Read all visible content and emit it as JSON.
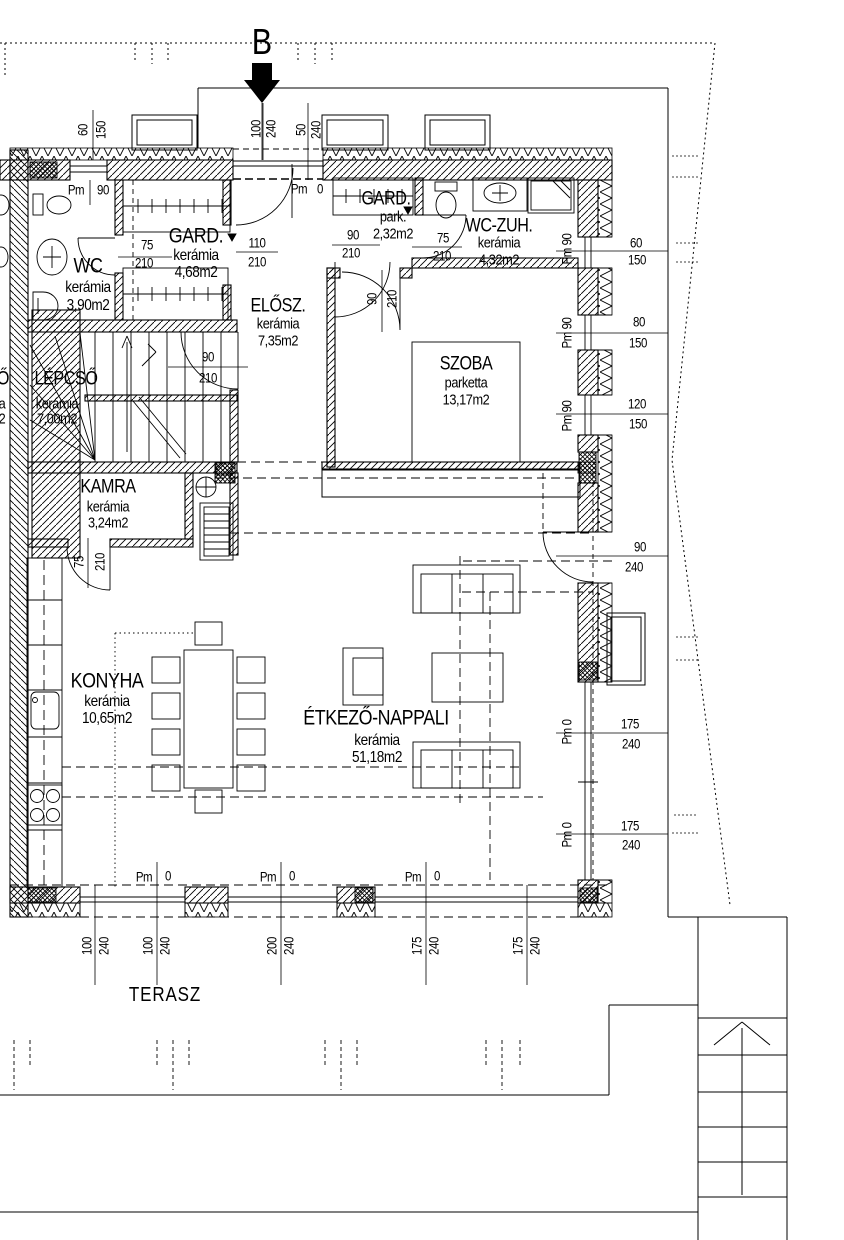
{
  "drawing": {
    "section_marker": "B",
    "terrace_label": "TERASZ",
    "colors": {
      "line": "#000000",
      "background": "#ffffff"
    },
    "rooms": [
      {
        "name": "WC",
        "floor": "kerámia",
        "area": "3,90m2",
        "x": 88,
        "ny": 266,
        "fy": 288,
        "ay": 306,
        "ns": 21,
        "ss": 16
      },
      {
        "name": "GARD.",
        "floor": "kerámia",
        "area": "4,68m2",
        "x": 196,
        "ny": 236,
        "fy": 256,
        "ay": 273,
        "ns": 21,
        "ss": 16
      },
      {
        "name": "ELŐSZ.",
        "floor": "kerámia",
        "area": "7,35m2",
        "x": 278,
        "ny": 306,
        "fy": 324,
        "ay": 341,
        "ns": 19,
        "ss": 15
      },
      {
        "name": "GARD.",
        "floor": "park.",
        "area": "2,32m2",
        "x": 386,
        "ny": 199,
        "fy": 217,
        "sx": 393,
        "ay": 234,
        "ns": 19,
        "ss": 15
      },
      {
        "name": "WC-ZUH.",
        "floor": "kerámia",
        "area": "4,32m2",
        "x": 499,
        "ny": 226,
        "fy": 243,
        "ay": 260,
        "ns": 19,
        "ss": 15
      },
      {
        "name": "SZOBA",
        "floor": "parketta",
        "area": "13,17m2",
        "x": 466,
        "ny": 364,
        "fy": 383,
        "ay": 400,
        "ns": 19,
        "ss": 15
      },
      {
        "name": "LÉPCSŐ",
        "floor": "kerámia",
        "area": "7,00m2",
        "x": 66,
        "ny": 379,
        "sx": 57,
        "fy": 404,
        "ay": 419,
        "ns": 19,
        "ss": 15
      },
      {
        "name": "KAMRA",
        "floor": "kerámia",
        "area": "3,24m2",
        "x": 108,
        "ny": 487,
        "fy": 507,
        "ay": 523,
        "ns": 19,
        "ss": 15
      },
      {
        "name": "KONYHA",
        "floor": "kerámia",
        "area": "10,65m2",
        "x": 107,
        "ny": 681,
        "fy": 702,
        "ay": 719,
        "ns": 21,
        "ss": 16
      },
      {
        "name": "ÉTKEZŐ-NAPPALI",
        "floor": "kerámia",
        "area": "51,18m2",
        "x": 376,
        "ny": 718,
        "sx": 377,
        "fy": 741,
        "ay": 758,
        "ns": 21,
        "ss": 16
      }
    ],
    "partial_labels": [
      {
        "t": "Ő",
        "x": 3,
        "y": 379,
        "s": 19
      },
      {
        "t": "a",
        "x": 2,
        "y": 404,
        "s": 15
      },
      {
        "t": "2",
        "x": 2,
        "y": 419,
        "s": 15
      }
    ],
    "dim_labels": [
      {
        "t": "60",
        "x": 83,
        "y": 130,
        "r": -90
      },
      {
        "t": "150",
        "x": 101,
        "y": 130,
        "r": -90
      },
      {
        "t": "100",
        "x": 256,
        "y": 129,
        "r": -90
      },
      {
        "t": "240",
        "x": 271,
        "y": 129,
        "r": -90
      },
      {
        "t": "50",
        "x": 301,
        "y": 130,
        "r": -90
      },
      {
        "t": "240",
        "x": 316,
        "y": 130,
        "r": -90
      },
      {
        "t": "Pm",
        "x": 76,
        "y": 190
      },
      {
        "t": "90",
        "x": 103,
        "y": 190
      },
      {
        "t": "Pm",
        "x": 299,
        "y": 189
      },
      {
        "t": "0",
        "x": 320,
        "y": 189
      },
      {
        "t": "75",
        "x": 147,
        "y": 245
      },
      {
        "t": "210",
        "x": 144,
        "y": 263
      },
      {
        "t": "110",
        "x": 257,
        "y": 243
      },
      {
        "t": "210",
        "x": 257,
        "y": 262
      },
      {
        "t": "90",
        "x": 353,
        "y": 235
      },
      {
        "t": "210",
        "x": 351,
        "y": 253
      },
      {
        "t": "75",
        "x": 443,
        "y": 238
      },
      {
        "t": "210",
        "x": 442,
        "y": 256
      },
      {
        "t": "90",
        "x": 208,
        "y": 357
      },
      {
        "t": "210",
        "x": 208,
        "y": 378
      },
      {
        "t": "90",
        "x": 372,
        "y": 299,
        "r": -90
      },
      {
        "t": "210",
        "x": 392,
        "y": 299,
        "r": -90
      },
      {
        "t": "75",
        "x": 79,
        "y": 562,
        "r": -90
      },
      {
        "t": "210",
        "x": 100,
        "y": 562,
        "r": -90
      },
      {
        "t": "Pm 90",
        "x": 567,
        "y": 249,
        "r": -90
      },
      {
        "t": "Pm 90",
        "x": 567,
        "y": 333,
        "r": -90
      },
      {
        "t": "Pm 90",
        "x": 567,
        "y": 416,
        "r": -90
      },
      {
        "t": "Pm 0",
        "x": 567,
        "y": 732,
        "r": -90
      },
      {
        "t": "Pm 0",
        "x": 567,
        "y": 835,
        "r": -90
      },
      {
        "t": "60",
        "x": 636,
        "y": 243
      },
      {
        "t": "150",
        "x": 637,
        "y": 260
      },
      {
        "t": "80",
        "x": 639,
        "y": 322
      },
      {
        "t": "150",
        "x": 638,
        "y": 343
      },
      {
        "t": "120",
        "x": 637,
        "y": 404
      },
      {
        "t": "150",
        "x": 638,
        "y": 424
      },
      {
        "t": "90",
        "x": 640,
        "y": 547
      },
      {
        "t": "240",
        "x": 634,
        "y": 567
      },
      {
        "t": "175",
        "x": 630,
        "y": 724
      },
      {
        "t": "240",
        "x": 631,
        "y": 744
      },
      {
        "t": "175",
        "x": 630,
        "y": 826
      },
      {
        "t": "240",
        "x": 631,
        "y": 845
      },
      {
        "t": "Pm",
        "x": 144,
        "y": 877
      },
      {
        "t": "0",
        "x": 168,
        "y": 876
      },
      {
        "t": "Pm",
        "x": 268,
        "y": 877
      },
      {
        "t": "0",
        "x": 292,
        "y": 876
      },
      {
        "t": "Pm",
        "x": 413,
        "y": 877
      },
      {
        "t": "0",
        "x": 437,
        "y": 876
      },
      {
        "t": "100",
        "x": 87,
        "y": 946,
        "r": -90
      },
      {
        "t": "240",
        "x": 104,
        "y": 946,
        "r": -90
      },
      {
        "t": "100",
        "x": 148,
        "y": 946,
        "r": -90
      },
      {
        "t": "240",
        "x": 165,
        "y": 946,
        "r": -90
      },
      {
        "t": "200",
        "x": 272,
        "y": 946,
        "r": -90
      },
      {
        "t": "240",
        "x": 289,
        "y": 946,
        "r": -90
      },
      {
        "t": "175",
        "x": 417,
        "y": 946,
        "r": -90
      },
      {
        "t": "240",
        "x": 434,
        "y": 946,
        "r": -90
      },
      {
        "t": "175",
        "x": 518,
        "y": 946,
        "r": -90
      },
      {
        "t": "240",
        "x": 535,
        "y": 946,
        "r": -90
      }
    ]
  }
}
